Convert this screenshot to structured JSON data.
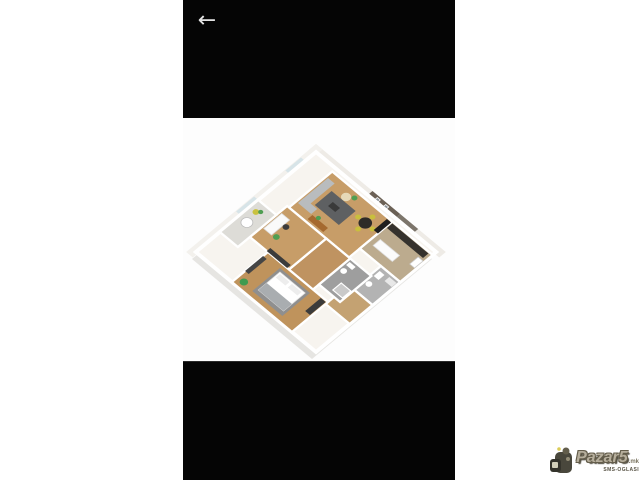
{
  "app": {
    "back_glyph": "←"
  },
  "image_viewer": {
    "description": "3D isometric render of a furnished apartment floor plan, viewed from above at a 45-degree rotation on a white background",
    "depicted_rooms": [
      "living room with gray corner sofa, dark rug and dining table with four yellow chairs",
      "kitchen with dark countertop and white island",
      "bathroom with gray tiles (far right)",
      "interior bathroom with gray tiles and shower",
      "bedroom with white bed and gray blanket (bottom)",
      "small bedroom / office with desk and green chair (left)",
      "balcony with round table and yellow flower plant (far left)",
      "hallway with wooden floor"
    ],
    "palette": {
      "wood_floor": "#c79d68",
      "wall_white": "#ffffff",
      "accent_wall": "#6b6156",
      "tile_gray": "#9e9e9e",
      "sofa_gray": "#b9bcbe",
      "chair_yellow": "#c9bf3d",
      "plant_green": "#3f9b4f",
      "bed_blanket": "#8f8f8f",
      "letterbox_black": "#050505"
    }
  },
  "watermark": {
    "brand": "Pazar5",
    "tld": ".mk",
    "tagline": "SMS-OGLASI"
  }
}
